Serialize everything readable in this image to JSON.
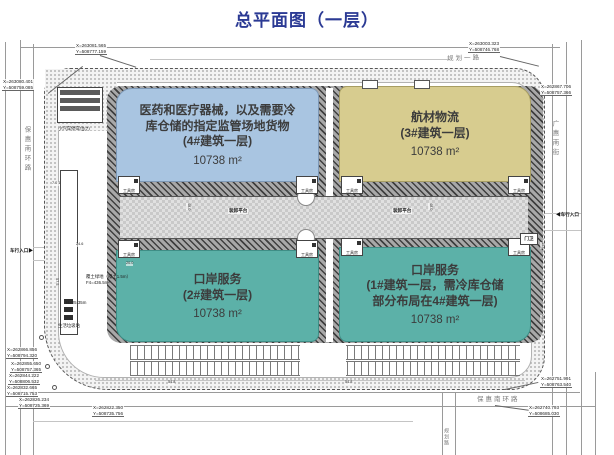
{
  "title": "总平面图（一层）",
  "buildings": {
    "b4": {
      "label": "医药和医疗器械，以及需要冷\n库仓储的指定监管场地货物\n(4#建筑一层)",
      "area": "10738 m²"
    },
    "b3": {
      "label": "航材物流\n(3#建筑一层)",
      "area": "10738 m²"
    },
    "b2": {
      "label": "口岸服务\n(2#建筑一层)",
      "area": "10738 m²"
    },
    "b1": {
      "label": "口岸服务\n(1#建筑一层，需冷库仓储\n部分布局在4#建筑一层)",
      "area": "10738 m²"
    }
  },
  "roads": {
    "left": "保惠南环路",
    "right": "广惠南街",
    "top": "规划一路",
    "bottom": "保惠南环路",
    "bottom_vertical": "规划路"
  },
  "site_labels": {
    "loading_platform": "装卸平台",
    "tool_room": "工具房",
    "guard_house": "门卫",
    "vehicle_entrance_right": "◀车行入口",
    "vehicle_entrance_left": "车行入口▶",
    "green_roof": "覆土绿地（覆土1.5m）\nF4=436.5m²",
    "height_note": "H=25.35m",
    "garbage_station": "生活垃圾站",
    "parking_note": "小汽车停车位(7)"
  },
  "coordinates": {
    "tl1": "X=263081.565\nY=508777.159",
    "tl2": "X=263080.401\nY=508759.085",
    "tr1": "X=263003.323\nY=508746.768",
    "tr2": "X=262867.706\nY=508757.366",
    "bl1": "X=262866.856\nY=508794.320",
    "bl2": "X=262855.650\nY=508757.365",
    "bl3": "X=262844.222\nY=508806.532",
    "bl4": "X=262832.665\nY=508715.753",
    "bl5": "X=262826.234\nY=508725.369",
    "bl6": "X=262822.350\nY=508735.756",
    "br1": "X=262751.991\nY=508763.540",
    "br2": "X=262740.793\nY=508685.030"
  },
  "dimensions": {
    "yard_left": "48.0",
    "yard_right": "48.0",
    "left_building": "57.5",
    "left_top": "7.0 10.6 4.0",
    "green_width": "24.6",
    "left_mid": "20.0",
    "right_d1": "15.0",
    "right_d2": "3.0",
    "right_d3": "20.0",
    "bottom_d": "54.8"
  },
  "colors": {
    "title": "#2b3a94",
    "block_medical": "#a9c5e1",
    "block_aviation": "#d7cc8f",
    "block_port": "#5cb1a8"
  }
}
